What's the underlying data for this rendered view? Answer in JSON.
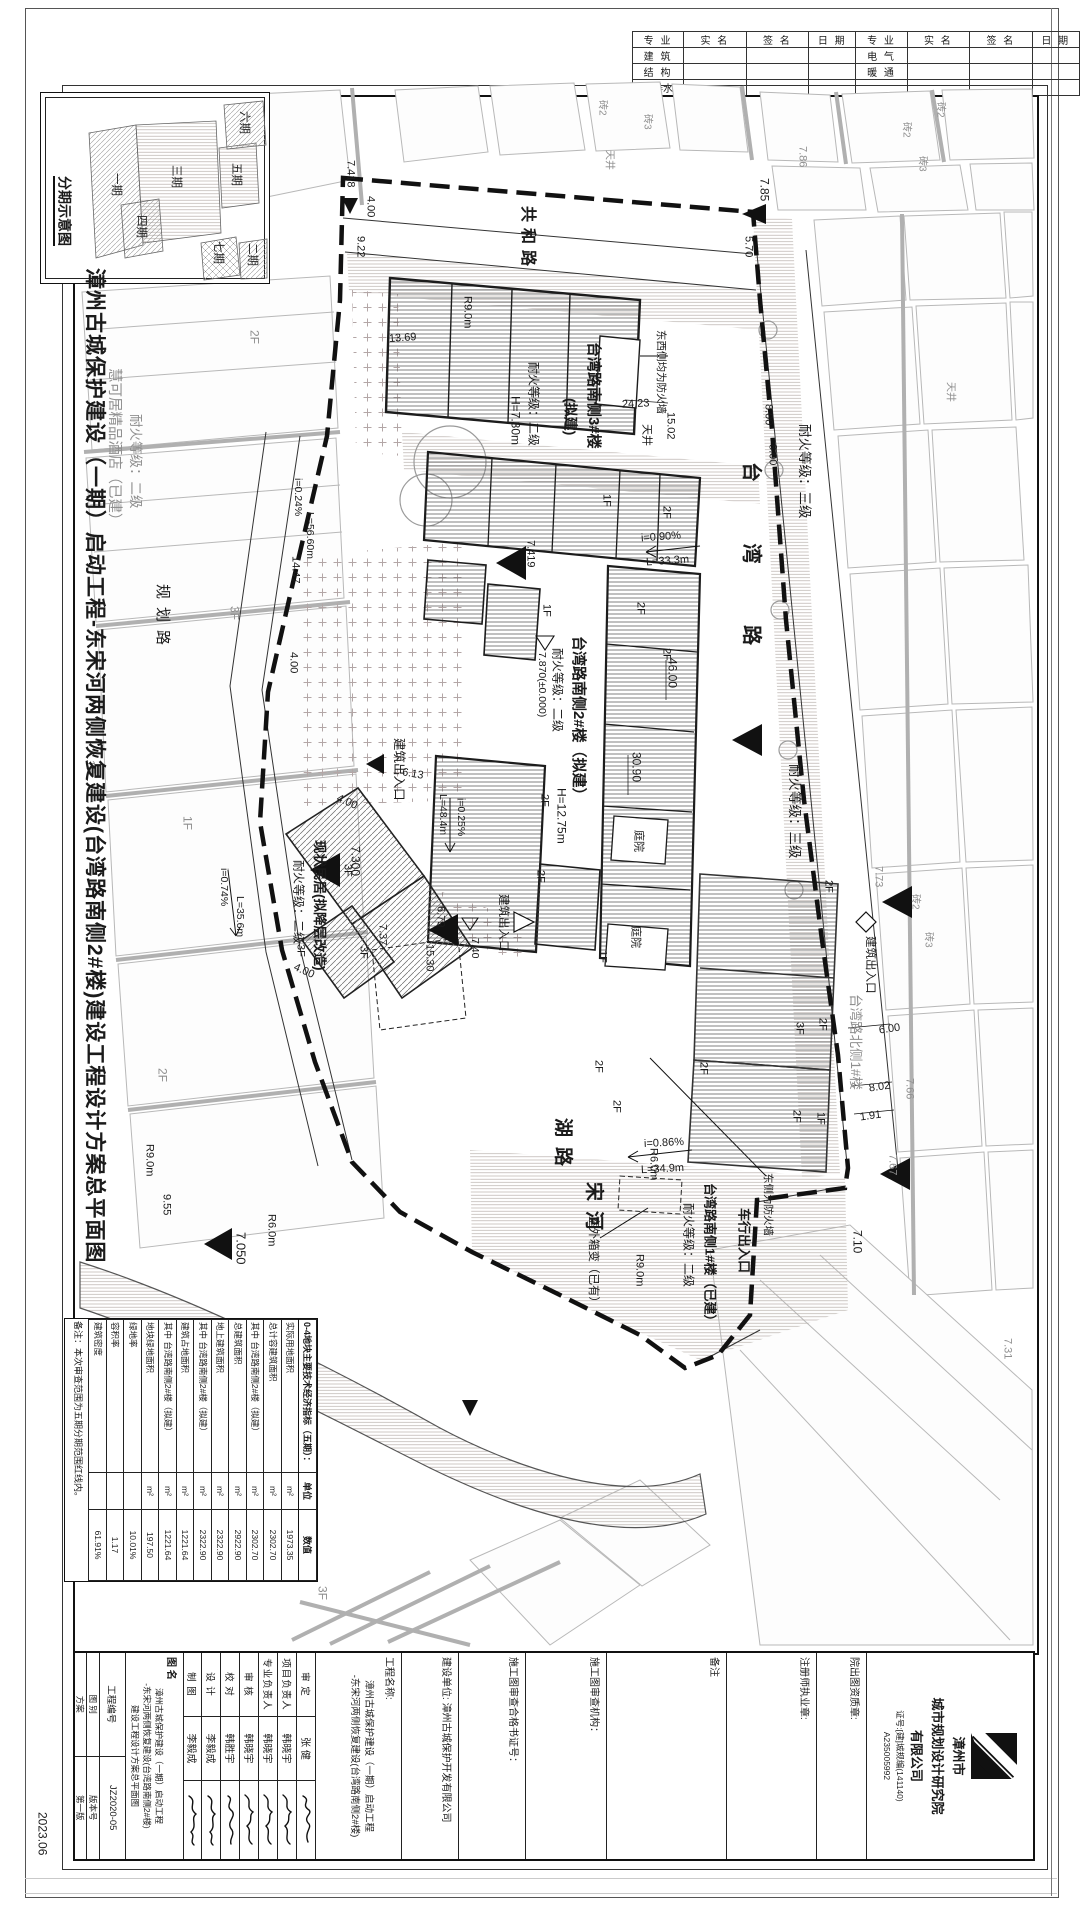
{
  "sig_table": {
    "headers": [
      "专 业",
      "实 名",
      "签 名",
      "日 期",
      "专 业",
      "实 名",
      "签 名",
      "日 期"
    ],
    "rows": [
      [
        "建 筑",
        "",
        "",
        "",
        "电 气",
        "",
        "",
        ""
      ],
      [
        "结 构",
        "",
        "",
        "",
        "暖 通",
        "",
        "",
        ""
      ],
      [
        "给排水",
        "",
        "",
        "",
        "",
        "",
        "",
        ""
      ]
    ]
  },
  "inset": {
    "title": "分期示意图",
    "phases": [
      "一期",
      "二期",
      "三期",
      "四期",
      "五期",
      "六期",
      "七期"
    ]
  },
  "side_title": "漳州古城保护建设（一期）启动工程-东宋河两侧恢复建设(台湾路南侧2#楼)建设工程设计方案总平面图",
  "plan": {
    "gonghe": "共和路",
    "taiwan": "台 湾 路",
    "guihua": "规划路",
    "hulu": "湖路",
    "songhe": "宋河",
    "b3_name": "台湾路南侧3#楼",
    "b3_sub": "(拟建)",
    "b3_fire": "耐火等级：二级",
    "b3_h": "H=7.30m",
    "tianjing": "天井",
    "fw_both": "东西侧均为防火墙",
    "b2_name": "台湾路南侧2#楼（拟建）",
    "b2_fire": "耐火等级：二级",
    "b2_h": "H=12.75m",
    "el7870": "7.870(±0.000)",
    "b1_name": "台湾路南侧1#楼（已建）",
    "b1_fire": "耐火等级：二级",
    "fw_east": "东侧为防火墙",
    "che": "车行出入口",
    "m_name": "现状民居(拟降层改造)",
    "m_fire": "耐火等级：二级",
    "hotel_name": "慧可居精品酒店（已建）",
    "hotel_fire": "耐火等级：二级",
    "north1": "台湾路北侧1#楼",
    "fire3": "耐火等级：三级",
    "zh2": "砖2",
    "zh3": "砖3",
    "ent": "建筑出入口",
    "box": "室外箱变（已有）",
    "i090": "i=0.90%",
    "l333": "L=33.3m",
    "i025": "i=0.25%",
    "l484": "L=48.4m",
    "i086": "i=0.86%",
    "l349": "L=34.9m",
    "i074": "i=0.74%",
    "l356": "L=35.6m",
    "i024": "i=0.24%",
    "l566": "L=56.60m",
    "d400": "4.00",
    "d922": "9.22",
    "d1369": "13.69",
    "d570": "5.70",
    "d800": "8.00",
    "d2423": "24.23",
    "d1502": "15.02",
    "d3090": "30.90",
    "d4600": "46.00",
    "d1447": "14.47",
    "d679": "6.79",
    "d613": "6.13",
    "d1530": "15.30",
    "d955": "9.55",
    "d600": "6.00",
    "d802": "8.02",
    "d191": "1.91",
    "d710": "7.10",
    "el7418": "7.418",
    "el785": "7.85",
    "el786": "7.86",
    "el7419": "7.419",
    "el7300": "7.300",
    "el737": "7.37",
    "el740": "7.40",
    "el7050": "7.050",
    "el773": "7.73",
    "el766": "7.66",
    "el767": "7.67",
    "el731": "7.31",
    "r90": "R9.0m",
    "r60": "R6.0m",
    "f1": "1F",
    "f2": "2F",
    "f3": "3F",
    "ty": "庭院"
  },
  "indicators": {
    "header": "0-4地块主要技术经济指标（五期）：",
    "col_unit": "单位",
    "col_value": "数值",
    "rows": [
      {
        "label": "实际用地面积",
        "unit": "m²",
        "value": "1973.35"
      },
      {
        "label": "总计容建筑面积",
        "unit": "m²",
        "value": "2302.70"
      },
      {
        "label": "其中 台湾路南侧2#楼（拟建）",
        "unit": "m²",
        "value": "2302.70"
      },
      {
        "label": "总建筑面积",
        "unit": "m²",
        "value": "2922.90"
      },
      {
        "label": "地上建筑面积",
        "unit": "m²",
        "value": "2322.90"
      },
      {
        "label": "其中 台湾路南侧2#楼（拟建）",
        "unit": "m²",
        "value": "2322.90"
      },
      {
        "label": "建筑占地面积",
        "unit": "m²",
        "value": "1221.64"
      },
      {
        "label": "其中 台湾路南侧2#楼（拟建）",
        "unit": "m²",
        "value": "1221.64"
      },
      {
        "label": "地块绿地面积",
        "unit": "m²",
        "value": "197.50"
      },
      {
        "label": "绿地率",
        "unit": "",
        "value": "10.01%"
      },
      {
        "label": "容积率",
        "unit": "",
        "value": "1.17"
      },
      {
        "label": "建筑密度",
        "unit": "",
        "value": "61.91%"
      }
    ],
    "note": "备注：本次审查范围为五期分期范围红线内。"
  },
  "titleblock": {
    "company_l1": "漳州市",
    "company_l2": "城市规划设计研究院",
    "company_l3": "有限公司",
    "company_cert1": "证号:[建]城规编(141140)",
    "company_cert2": "A235005992",
    "inst_seal_label": "院出图资质章:",
    "reg_seal_label": "注册师执业章:",
    "remark_label": "备注",
    "review_org_label": "施工图审查机构：",
    "cert_no_label": "施工图审查合格书证号：",
    "client_label": "建设单位:",
    "client": "漳州古城保护开发有限公司",
    "proj_name_label": "工程名称:",
    "proj_name_l1": "漳州古城保护建设（一期）启动工程",
    "proj_name_l2": "-东宋河两侧恢复建设(台湾路南侧2#楼)",
    "staff": [
      {
        "role": "审 定",
        "name": "张 健"
      },
      {
        "role": "项目负责人",
        "name": "韩晓宇"
      },
      {
        "role": "专业负责人",
        "name": "韩晓宇"
      },
      {
        "role": "审 核",
        "name": "韩晓宇"
      },
      {
        "role": "校 对",
        "name": "韩胜宇"
      },
      {
        "role": "设 计",
        "name": "李毅成"
      },
      {
        "role": "制 图",
        "name": "李毅成"
      }
    ],
    "tu_ming_label": "图 名",
    "tu_ming_l1": "漳州古城保护建设（一期）启动工程",
    "tu_ming_l2": "-东宋河两侧恢复建设(台湾路南侧2#楼)",
    "tu_ming_l3": "建设工程设计方案总平面图",
    "proj_no_label": "工程编号",
    "proj_no": "JZ2020-05",
    "tu_bie_label": "图 别",
    "tu_bie": "方案",
    "ban_ben_label": "版本号",
    "ban_ben": "第一版",
    "date": "2023.06"
  }
}
